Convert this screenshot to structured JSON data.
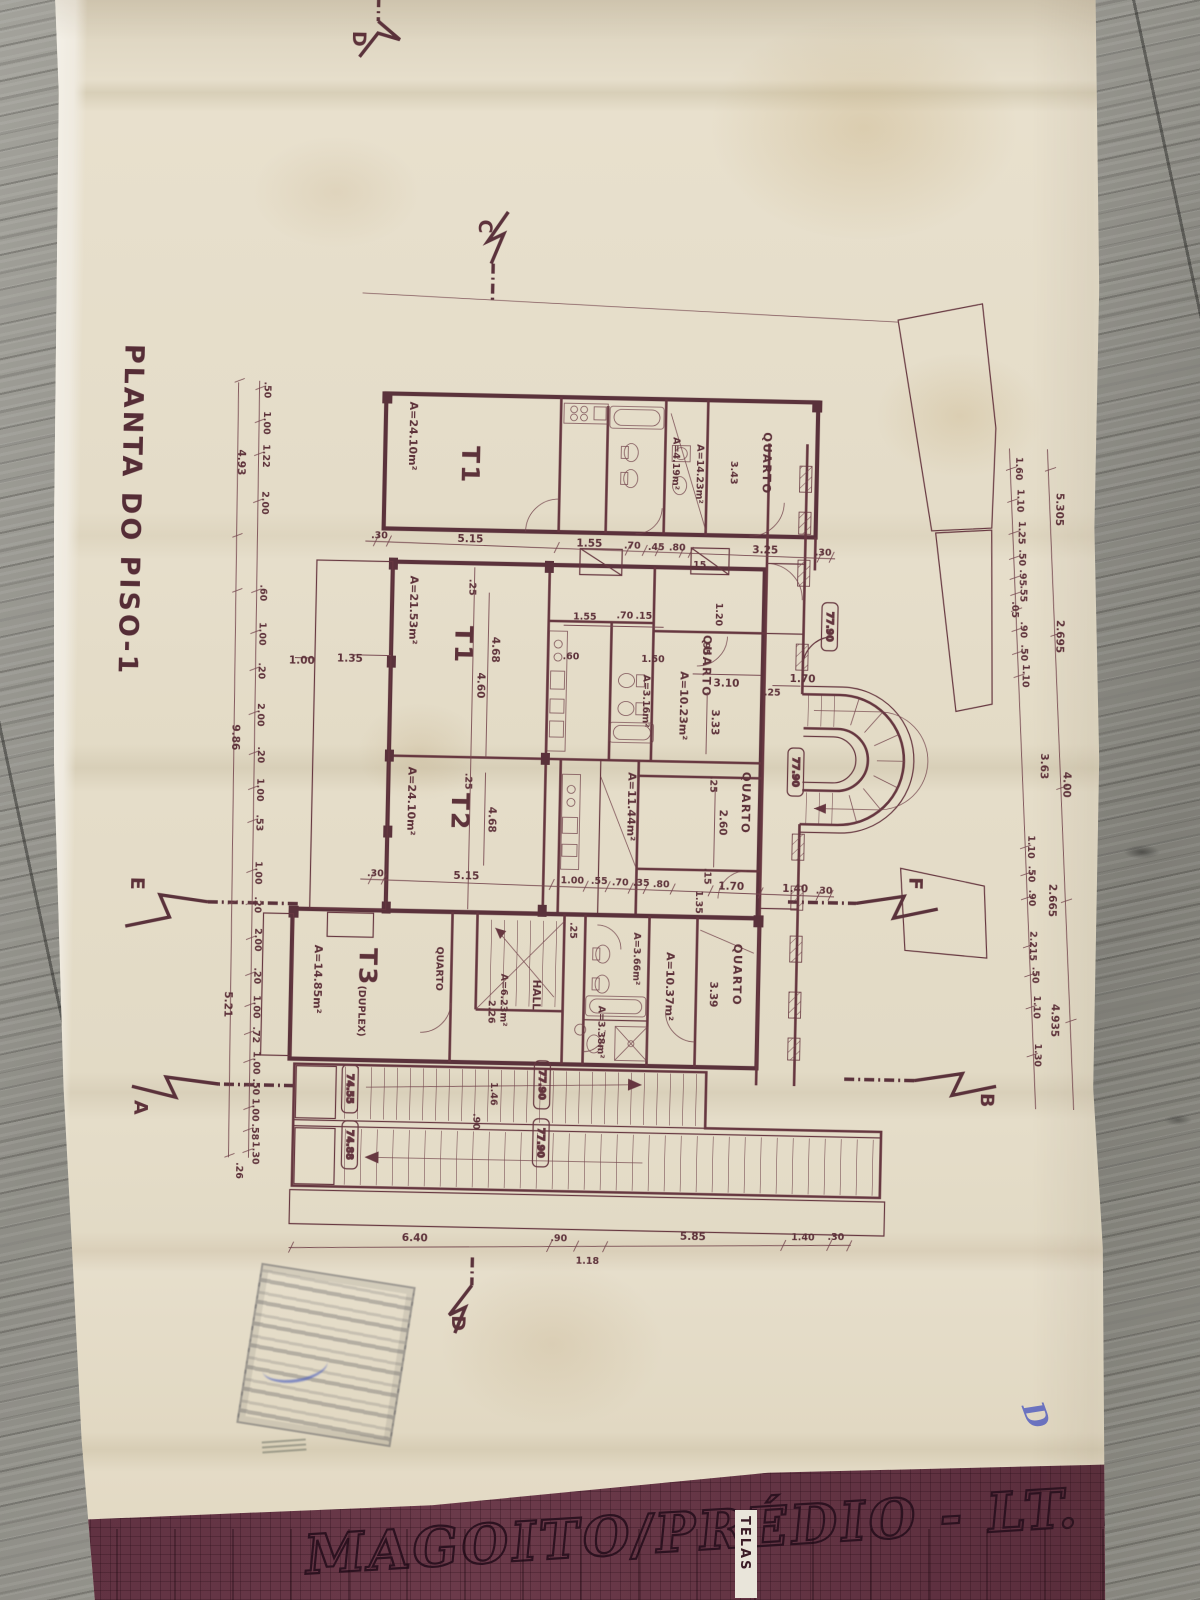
{
  "colors": {
    "ink": "#5c2a35",
    "paper": "#e4dcc8",
    "band": "#5e3040",
    "wood": "#8e8d86",
    "blue_pen": "#5661c0"
  },
  "plan": {
    "title": "PLANTA DO PISO-1",
    "markers": {
      "top_d": "D",
      "top_c": "C",
      "left_e": "E",
      "left_a": "A",
      "right_f": "F",
      "right_b": "B",
      "bottom_d": "D"
    },
    "rooms": {
      "t1a": {
        "name": "T1",
        "area": "A=24.10m²"
      },
      "bath_top": {
        "area": "A=4.19m²"
      },
      "quarto_tr": {
        "name": "QUARTO",
        "area": "A=14.23m²",
        "w": "3.43"
      },
      "t1b": {
        "name": "T1",
        "area": "A=21.53m²",
        "w": "4.68",
        "w2": "4.60",
        "off": ".25"
      },
      "bath_mid": {
        "area": "A=3.16m²"
      },
      "quarto_mid": {
        "name": "QUARTO",
        "area": "A=10.23m²",
        "w": "3.10",
        "h": "3.33",
        "door": "1.20",
        "off": ".95"
      },
      "t2": {
        "name": "T2",
        "area": "A=24.10m²",
        "w": "4.68",
        "off": ".25"
      },
      "quarto_t2": {
        "name": "QUARTO",
        "area": "A=11.44m²",
        "h": "2.60",
        "off": ".25",
        "gap": ".15"
      },
      "t3": {
        "name": "T3",
        "suffix": "(DUPLEX)",
        "area": "A=14.85m²"
      },
      "quarto_t3": {
        "name": "QUARTO"
      },
      "stair_t3": {
        "area": "A=6.23m²",
        "h": "2.26",
        "off": ".25"
      },
      "hall": {
        "name": "HALL"
      },
      "bath_t3": {
        "area": "A=3.66m²"
      },
      "wc_t3": {
        "area": "A=3.38m²"
      },
      "dist_t3": {
        "area": "A=10.37m²"
      },
      "quarto_b": {
        "name": "QUARTO",
        "h": "3.39"
      }
    },
    "stair_bay": {
      "door": "1.70",
      "off": ".25",
      "level": "77.90"
    },
    "levels": {
      "upper_corridor": "77.90",
      "ext_upper": "77.90",
      "ext_lower": "77.90",
      "left_upper": "74.55",
      "left_lower": "74.88"
    },
    "ext_stair": {
      "run": "1.46",
      "width": ".90"
    },
    "terrace": {
      "w": "1.35",
      "d": "1.00"
    },
    "kitchen_dims": [
      "1.55",
      ".70",
      ".15",
      ".60",
      "1.50"
    ],
    "chains": {
      "band1": [
        ".30",
        "5.15",
        "1.55",
        ".70",
        ".45",
        ".80",
        ".15",
        "3.25",
        ".30"
      ],
      "band3": [
        ".30",
        "5.15",
        "1.00",
        ".55",
        ".70",
        ".35",
        ".80",
        "1.35",
        "1.70",
        "1.40",
        ".30"
      ],
      "bottom": [
        "6.40",
        ".90",
        "1.18",
        "5.85",
        "1.40",
        ".30"
      ],
      "left_inner": [
        ".50",
        "1.00",
        "1.22",
        "2.00",
        ".60",
        "1.00",
        ".20",
        "2.00",
        ".20",
        "1.00",
        ".53",
        "1.00",
        ".20",
        "2.00",
        ".20",
        "1.00",
        ".72",
        "1.00",
        ".50",
        "1.00",
        ".58",
        "1.30"
      ],
      "left_outer": [
        "4.93",
        "9.86",
        "5.21",
        ".26"
      ],
      "right_inner": [
        "1.60",
        "1.10",
        "1.25",
        ".50",
        ".95",
        ".55",
        ".05",
        ".90",
        ".50",
        "1.10",
        "1.10",
        ".50",
        ".90",
        "2.215",
        ".50",
        "1.10",
        "1.30"
      ],
      "right_outer": [
        "5.305",
        "2.695",
        "3.63",
        "4.00",
        "2.665",
        "4.935"
      ]
    },
    "title_block": {
      "project": "MAGOITO/PRÉDIO - LT. 2A",
      "side_label": "TELAS"
    },
    "handwritten": "D"
  }
}
